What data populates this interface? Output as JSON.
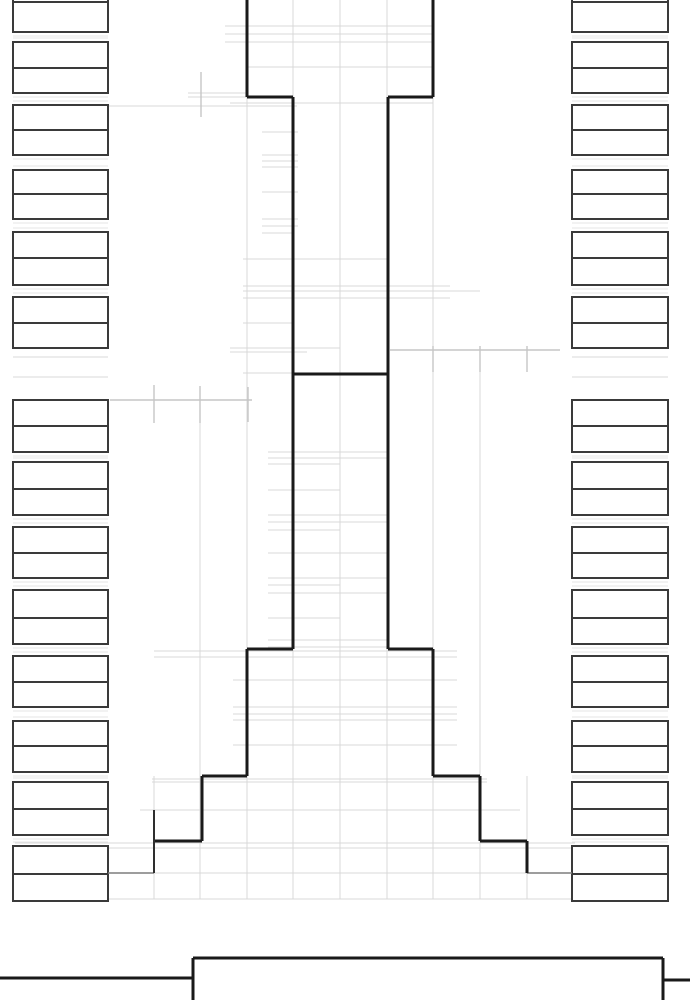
{
  "colors": {
    "background": "#ffffff",
    "profile_line": "#1a1a1a",
    "secondary_line": "#2e2e2e",
    "box_border": "#3a3a3a",
    "box_fill": "#ffffff",
    "grid_line": "#d9d9d9",
    "gap_line": "#e6e6e6",
    "dimension_line": "#c6c6c6",
    "leader_line": "#7d7d7d"
  },
  "canvas": {
    "width": 690,
    "height": 1000
  },
  "tower_profile": {
    "segments": [
      [
        247,
        0,
        247,
        97
      ],
      [
        433,
        0,
        433,
        97
      ],
      [
        247,
        97,
        293,
        97
      ],
      [
        388,
        97,
        433,
        97
      ],
      [
        293,
        97,
        293,
        649
      ],
      [
        388,
        97,
        388,
        649
      ],
      [
        293,
        374,
        388,
        374
      ],
      [
        247,
        649,
        293,
        649
      ],
      [
        388,
        649,
        433,
        649
      ],
      [
        247,
        649,
        247,
        776
      ],
      [
        433,
        649,
        433,
        776
      ],
      [
        202,
        776,
        247,
        776
      ],
      [
        433,
        776,
        480,
        776
      ],
      [
        202,
        776,
        202,
        841
      ],
      [
        480,
        776,
        480,
        841
      ],
      [
        154,
        841,
        202,
        841
      ],
      [
        480,
        841,
        527,
        841
      ],
      [
        527,
        841,
        527,
        873
      ]
    ],
    "secondary_segments": [
      [
        154,
        810,
        154,
        873
      ]
    ]
  },
  "label_columns": {
    "left": {
      "x": 13,
      "box_width": 95,
      "groups": [
        [
          -24,
          2,
          32
        ],
        [
          42,
          68,
          93
        ],
        [
          105,
          130,
          155
        ],
        [
          170,
          194,
          219
        ],
        [
          232,
          258,
          285
        ],
        [
          297,
          323,
          348
        ],
        [
          400,
          426,
          452
        ],
        [
          462,
          489,
          515
        ],
        [
          527,
          553,
          578
        ],
        [
          590,
          618,
          644
        ],
        [
          656,
          682,
          707
        ],
        [
          721,
          746,
          772
        ],
        [
          782,
          809,
          835
        ],
        [
          846,
          874,
          901
        ]
      ]
    },
    "right": {
      "x": 572,
      "box_width": 96,
      "groups": [
        [
          -24,
          2,
          32
        ],
        [
          42,
          68,
          93
        ],
        [
          105,
          130,
          155
        ],
        [
          170,
          194,
          219
        ],
        [
          232,
          258,
          285
        ],
        [
          297,
          323,
          348
        ],
        [
          400,
          426,
          452
        ],
        [
          462,
          489,
          515
        ],
        [
          527,
          553,
          578
        ],
        [
          590,
          618,
          644
        ],
        [
          656,
          682,
          707
        ],
        [
          721,
          746,
          772
        ],
        [
          782,
          809,
          835
        ],
        [
          846,
          874,
          901
        ]
      ]
    }
  },
  "grid": {
    "verticals": [
      [
        293,
        0,
        899
      ],
      [
        340,
        0,
        899
      ],
      [
        387,
        0,
        899
      ],
      [
        247,
        97,
        899
      ],
      [
        433,
        97,
        899
      ],
      [
        200,
        423,
        899
      ],
      [
        480,
        372,
        899
      ],
      [
        154,
        776,
        899
      ],
      [
        527,
        776,
        899
      ]
    ],
    "horizontals": [
      [
        26,
        225,
        433
      ],
      [
        34,
        225,
        433
      ],
      [
        42,
        225,
        433
      ],
      [
        67,
        247,
        433
      ],
      [
        93,
        188,
        248
      ],
      [
        97,
        188,
        248
      ],
      [
        103,
        230,
        433
      ],
      [
        106,
        102,
        297
      ],
      [
        132,
        262,
        298
      ],
      [
        155,
        262,
        298
      ],
      [
        161,
        262,
        298
      ],
      [
        167,
        262,
        298
      ],
      [
        192,
        262,
        298
      ],
      [
        219,
        262,
        298
      ],
      [
        226,
        262,
        298
      ],
      [
        233,
        262,
        293
      ],
      [
        259,
        243,
        388
      ],
      [
        286,
        243,
        450
      ],
      [
        291,
        243,
        480
      ],
      [
        298,
        243,
        450
      ],
      [
        323,
        243,
        293
      ],
      [
        348,
        230,
        340
      ],
      [
        352,
        230,
        307
      ],
      [
        373,
        243,
        293
      ],
      [
        357,
        13,
        108
      ],
      [
        377,
        13,
        108
      ],
      [
        357,
        572,
        668
      ],
      [
        377,
        572,
        668
      ],
      [
        452,
        268,
        387
      ],
      [
        458,
        268,
        387
      ],
      [
        464,
        268,
        340
      ],
      [
        490,
        268,
        340
      ],
      [
        515,
        268,
        387
      ],
      [
        522,
        268,
        387
      ],
      [
        530,
        268,
        340
      ],
      [
        553,
        268,
        387
      ],
      [
        578,
        268,
        387
      ],
      [
        585,
        268,
        340
      ],
      [
        593,
        268,
        387
      ],
      [
        618,
        268,
        340
      ],
      [
        640,
        268,
        387
      ],
      [
        647,
        268,
        387
      ],
      [
        651,
        154,
        457
      ],
      [
        657,
        154,
        457
      ],
      [
        680,
        233,
        457
      ],
      [
        707,
        233,
        457
      ],
      [
        714,
        233,
        457
      ],
      [
        720,
        233,
        457
      ],
      [
        745,
        233,
        457
      ],
      [
        779,
        152,
        487
      ],
      [
        782,
        152,
        487
      ],
      [
        810,
        140,
        520
      ],
      [
        843,
        15,
        575
      ],
      [
        848,
        15,
        575
      ],
      [
        873,
        110,
        570
      ],
      [
        899,
        43,
        647
      ]
    ]
  },
  "dimensions": {
    "lines": [
      [
        110,
        400,
        252,
        400
      ],
      [
        390,
        350,
        560,
        350
      ],
      [
        201,
        72,
        201,
        117
      ]
    ],
    "ticks": [
      [
        154,
        385,
        154,
        423
      ],
      [
        200,
        386,
        200,
        423
      ],
      [
        248,
        387,
        248,
        422
      ],
      [
        433,
        346,
        433,
        372
      ],
      [
        480,
        346,
        480,
        372
      ],
      [
        527,
        346,
        527,
        372
      ]
    ]
  },
  "leaders": [
    [
      108,
      873,
      154,
      873
    ],
    [
      527,
      873,
      572,
      873
    ]
  ],
  "base_structure": [
    [
      0,
      978,
      193,
      978
    ],
    [
      193,
      958,
      193,
      1002
    ],
    [
      193,
      958,
      663,
      958
    ],
    [
      663,
      958,
      663,
      1002
    ],
    [
      663,
      980,
      690,
      980
    ]
  ]
}
